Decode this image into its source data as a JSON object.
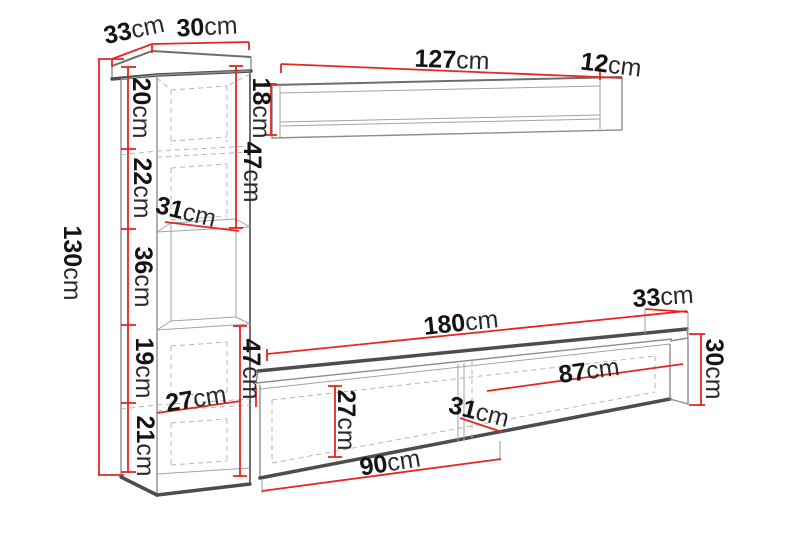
{
  "diagram_title": "wall-unit furniture dimensions",
  "colors": {
    "dimension_red": "#e8251f",
    "edge_dark": "#4d4d4d",
    "edge_light": "#8d8d8d",
    "text": "#141414"
  },
  "labels": {
    "cabinet": {
      "top_depth": {
        "value": "33",
        "unit": "cm"
      },
      "top_width": {
        "value": "30",
        "unit": "cm"
      },
      "height": {
        "value": "130",
        "unit": "cm"
      },
      "section1": {
        "value": "20",
        "unit": "cm"
      },
      "section2": {
        "value": "22",
        "unit": "cm"
      },
      "section3": {
        "value": "36",
        "unit": "cm"
      },
      "section4": {
        "value": "19",
        "unit": "cm"
      },
      "section5": {
        "value": "21",
        "unit": "cm"
      },
      "shelf_depth": {
        "value": "31",
        "unit": "cm"
      },
      "upper_span": {
        "value": "47",
        "unit": "cm"
      },
      "lower_span": {
        "value": "47",
        "unit": "cm"
      },
      "bottom_depth": {
        "value": "27",
        "unit": "cm"
      }
    },
    "wall_shelf": {
      "width": {
        "value": "127",
        "unit": "cm"
      },
      "depth": {
        "value": "12",
        "unit": "cm"
      },
      "height": {
        "value": "18",
        "unit": "cm"
      }
    },
    "tv_stand": {
      "width": {
        "value": "180",
        "unit": "cm"
      },
      "depth": {
        "value": "33",
        "unit": "cm"
      },
      "height": {
        "value": "30",
        "unit": "cm"
      },
      "right_compartment": {
        "value": "87",
        "unit": "cm"
      },
      "inner_depth": {
        "value": "31",
        "unit": "cm"
      },
      "inner_height": {
        "value": "27",
        "unit": "cm"
      },
      "left_compartment": {
        "value": "90",
        "unit": "cm"
      }
    }
  }
}
